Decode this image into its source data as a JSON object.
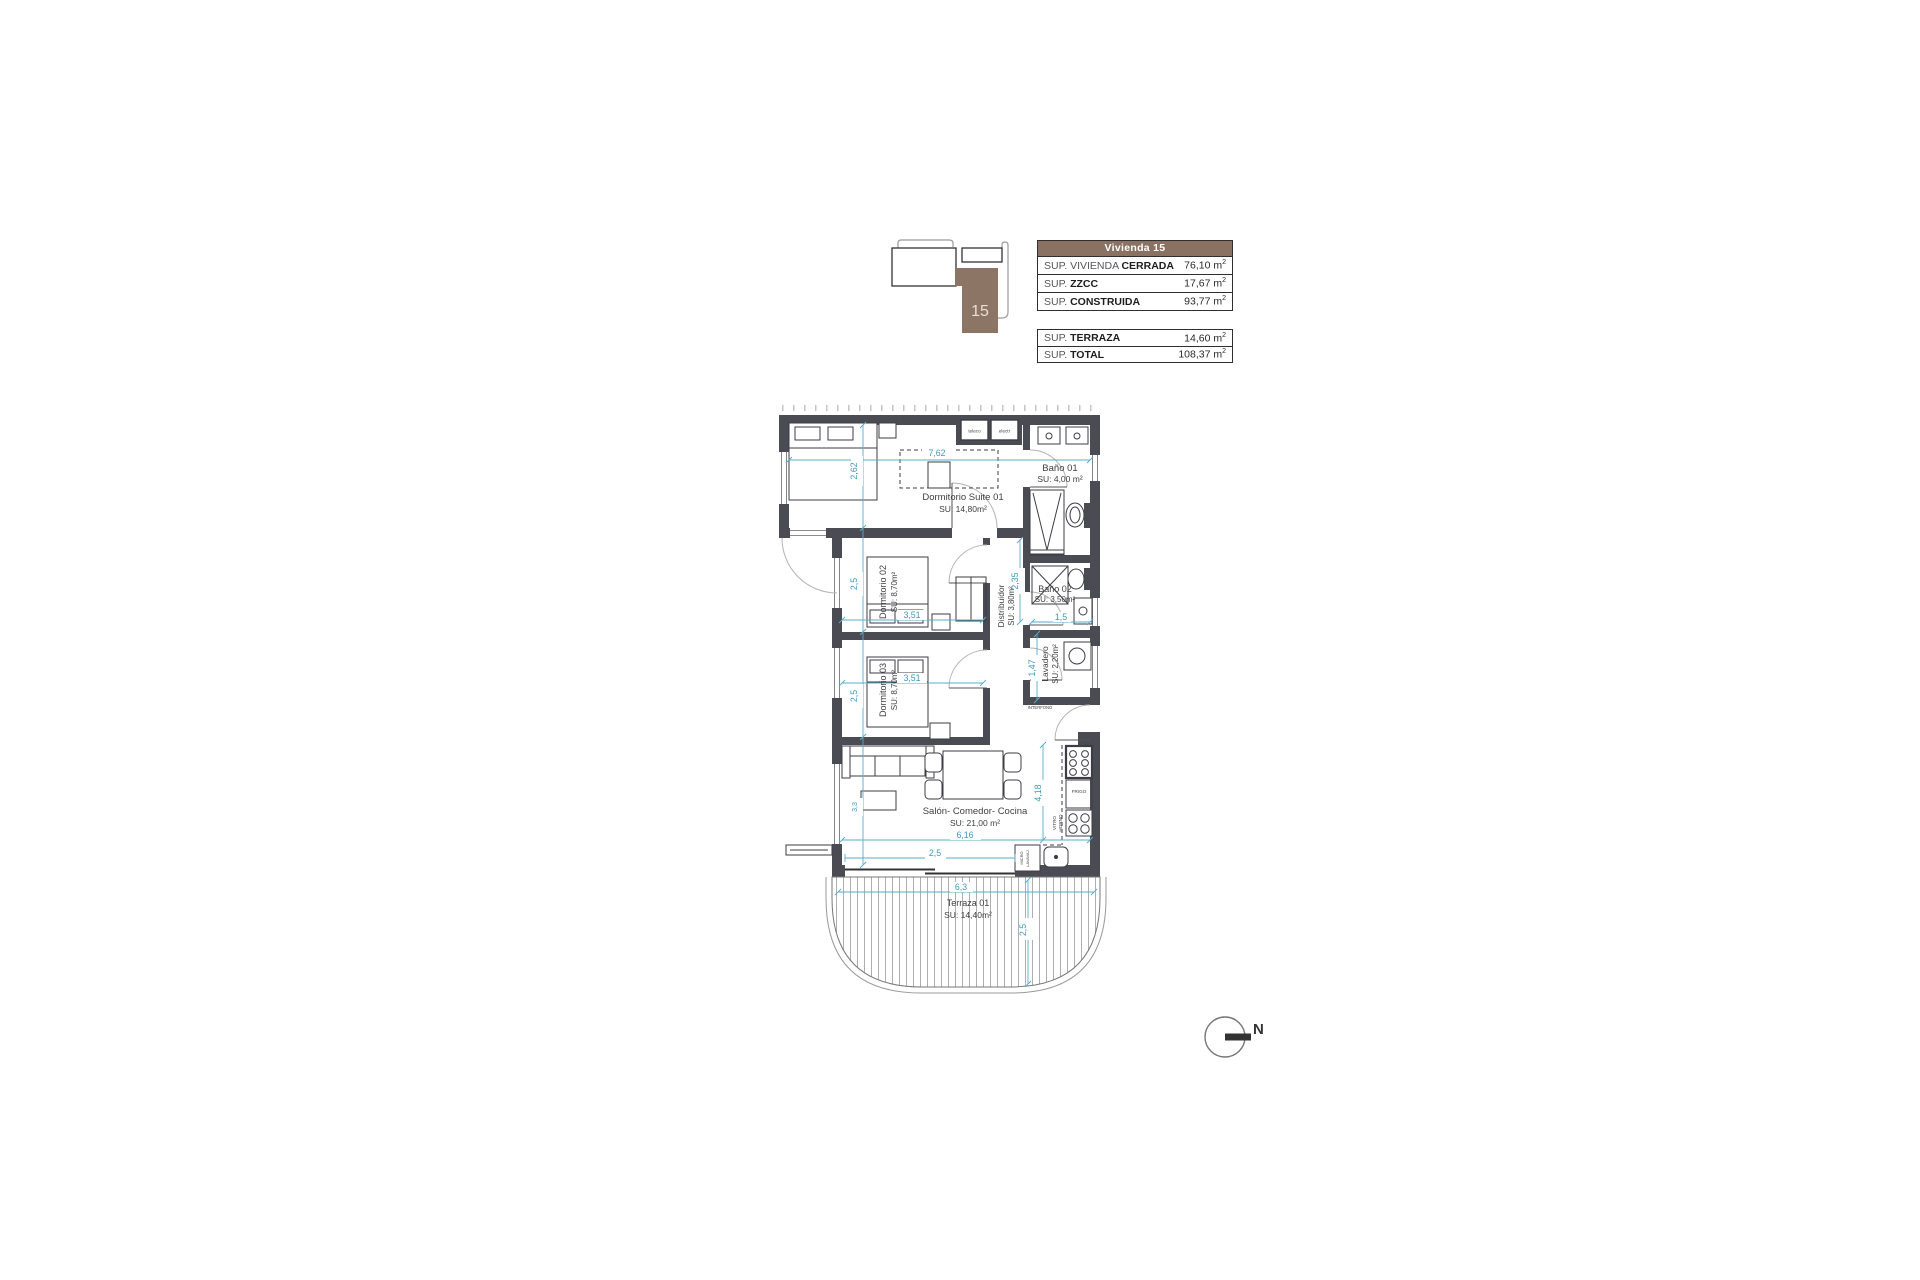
{
  "key_plan": {
    "unit_number": "15"
  },
  "area_tables": {
    "main": {
      "header": "Vivienda 15",
      "rows": [
        {
          "label_plain": "SUP. VIVIENDA ",
          "label_bold": "CERRADA",
          "value": "76,10 m",
          "sup": "2"
        },
        {
          "label_plain": "SUP. ",
          "label_bold": "ZZCC",
          "value": "17,67 m",
          "sup": "2"
        },
        {
          "label_plain": "SUP. ",
          "label_bold": "CONSTRUIDA",
          "value": "93,77 m",
          "sup": "2"
        }
      ]
    },
    "totals": {
      "rows": [
        {
          "label_plain": "SUP. ",
          "label_bold": "TERRAZA",
          "value": "14,60 m",
          "sup": "2"
        },
        {
          "label_plain": "SUP. ",
          "label_bold": "TOTAL",
          "value": "108,37 m",
          "sup": "2"
        }
      ]
    }
  },
  "rooms": {
    "suite": {
      "name": "Dormitorio Suite 01",
      "area": "SU: 14,80m²"
    },
    "bano1": {
      "name": "Baño 01",
      "area": "SU: 4,00 m²"
    },
    "dorm2": {
      "name": "Dormitorio 02",
      "area": "SU: 8,70m²"
    },
    "dorm3": {
      "name": "Dormitorio 03",
      "area": "SU: 8,70m²"
    },
    "distribuidor": {
      "name": "Distribuidor",
      "area": "SU: 3,80m²"
    },
    "bano2": {
      "name": "Baño 02",
      "area": "SU: 3,50m²"
    },
    "lavadero": {
      "name": "Lavadero",
      "area": "SU: 2,20m²"
    },
    "salon": {
      "name": "Salón- Comedor- Cocina",
      "area": "SU: 21,00 m²"
    },
    "terraza": {
      "name": "Terraza 01",
      "area": "SU: 14,40m²"
    }
  },
  "dimensions": {
    "suite_width": "7,62",
    "suite_depth": "2,62",
    "dorm2_width": "3,51",
    "dorm2_depth": "2,5",
    "dorm3_width": "3,51",
    "dorm3_depth": "2,5",
    "bano2_width": "1,5",
    "pasillo_depth": "2,35",
    "lavadero_depth": "1,47",
    "salon_width": "6,16",
    "salon_depth": "3,3",
    "salon_door_width": "2,5",
    "cocina_depth": "4,18",
    "terraza_width": "6,3",
    "terraza_depth": "2,5"
  },
  "fixture_labels": {
    "teleco": "teleco",
    "electr": "electr",
    "interfono": "INTERFONO",
    "frigo": "FRIGO",
    "vitro": "VITRO",
    "horno": "HORNO",
    "micro": "MICRO",
    "lavavajillas": "LAVAVAJ."
  },
  "compass": {
    "north": "N"
  },
  "colors": {
    "brand_brown": "#8a7161",
    "wall_gray": "#4b4b54",
    "dimension_cyan": "#3e9abd"
  }
}
